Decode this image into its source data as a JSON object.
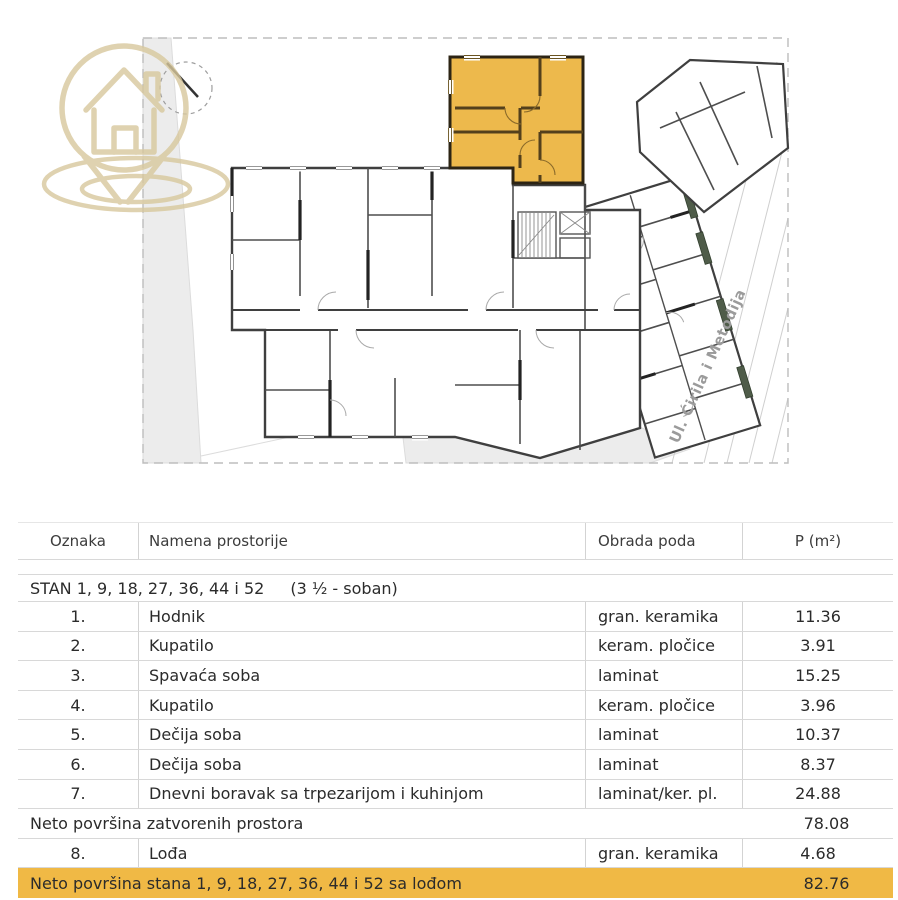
{
  "colors": {
    "accent": "#edb94c",
    "accentrow": "#f0b945",
    "planter": "#4f5c49",
    "logo": "#d8c89d"
  },
  "plan": {
    "street_label": "Ul. Ćirila i Metodija",
    "logo_icon": "house-location-pin",
    "north_icon": "north-compass"
  },
  "table": {
    "columns": {
      "c1": "Oznaka",
      "c2": "Namena prostorije",
      "c3": "Obrada poda",
      "c4": "P (m²)"
    },
    "section_title": "STAN 1, 9, 18, 27, 36, 44 i 52",
    "section_subtitle": "(3 ½ - soban)",
    "rows": [
      {
        "num": "1.",
        "name": "Hodnik",
        "floor": "gran. keramika",
        "area": "11.36"
      },
      {
        "num": "2.",
        "name": "Kupatilo",
        "floor": "keram. pločice",
        "area": "3.91"
      },
      {
        "num": "3.",
        "name": "Spavaća soba",
        "floor": "laminat",
        "area": "15.25"
      },
      {
        "num": "4.",
        "name": "Kupatilo",
        "floor": "keram. pločice",
        "area": "3.96"
      },
      {
        "num": "5.",
        "name": "Dečija soba",
        "floor": "laminat",
        "area": "10.37"
      },
      {
        "num": "6.",
        "name": "Dečija soba",
        "floor": "laminat",
        "area": "8.37"
      },
      {
        "num": "7.",
        "name": "Dnevni boravak sa trpezarijom i kuhinjom",
        "floor": "laminat/ker. pl.",
        "area": "24.88"
      },
      {
        "num": "8.",
        "name": "Lođa",
        "floor": "gran. keramika",
        "area": "4.68"
      }
    ],
    "subtotal": {
      "label": "Neto površina zatvorenih prostora",
      "area": "78.08"
    },
    "total": {
      "label": "Neto površina stana 1, 9, 18, 27, 36, 44 i 52 sa lođom",
      "area": "82.76"
    }
  }
}
